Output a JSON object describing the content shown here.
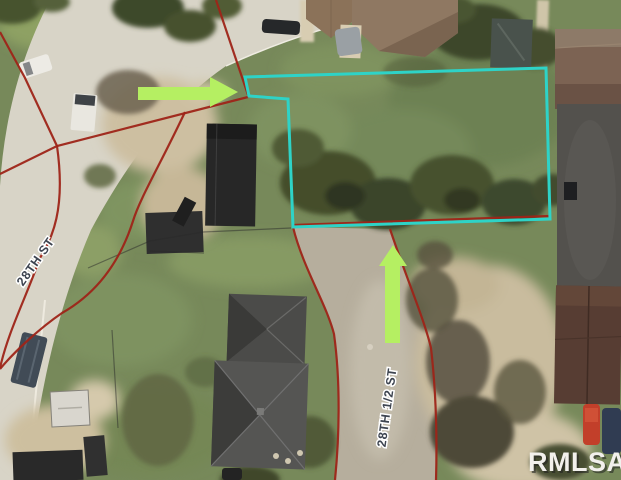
{
  "map": {
    "street_labels": {
      "street_28th": "28TH ST",
      "street_28th_half": "28TH 1/2 ST"
    },
    "watermark": {
      "text": "RMLSA",
      "color": "#f2f0ec"
    },
    "parcel_highlight": {
      "color": "#2ed3c7",
      "points": "245,77 546,68 550,219 293,227 288,99 249,96"
    },
    "arrows": {
      "color": "#b5ef62",
      "horizontal_points": "138,87 210,87 210,77 238,92 210,107 210,100 138,100",
      "vertical_points": "393,245 407,266 400,266 400,343 385,343 385,266 379,266"
    },
    "boundary_lines": {
      "color": "#9e2418",
      "paths": {
        "p1": "M216,0 L248,95",
        "p2": "M248,97 L57,146 L0,174",
        "p3": "M0,32 L25,78 L57,146",
        "p5": "M57,146 C66,210 52,238 40,258 C25,300 8,332 0,368",
        "p6": "M185,112 C160,165 140,198 133,221 C118,268 92,296 62,313 C40,328 15,351 0,369",
        "p7": "M293,227 C303,268 326,303 334,334 C341,385 339,440 335,480",
        "p8": "M390,229 C404,272 424,318 431,348 C437,400 437,445 436,480",
        "p9": "M293,225 L549,216"
      }
    }
  }
}
